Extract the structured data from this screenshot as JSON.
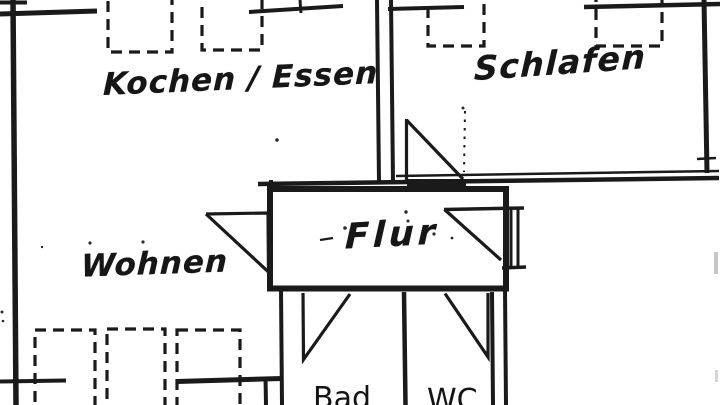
{
  "plan": {
    "rooms": [
      {
        "id": "kochen-essen",
        "label": "Kochen / Essen"
      },
      {
        "id": "schlafen",
        "label": "Schlafen"
      },
      {
        "id": "wohnen",
        "label": "Wohnen"
      },
      {
        "id": "flur",
        "label": "Flur"
      },
      {
        "id": "bad",
        "label": "Bad"
      },
      {
        "id": "wc",
        "label": "WC"
      }
    ]
  },
  "colors": {
    "ink": "#1a1a1a",
    "paper": "#ffffff"
  }
}
